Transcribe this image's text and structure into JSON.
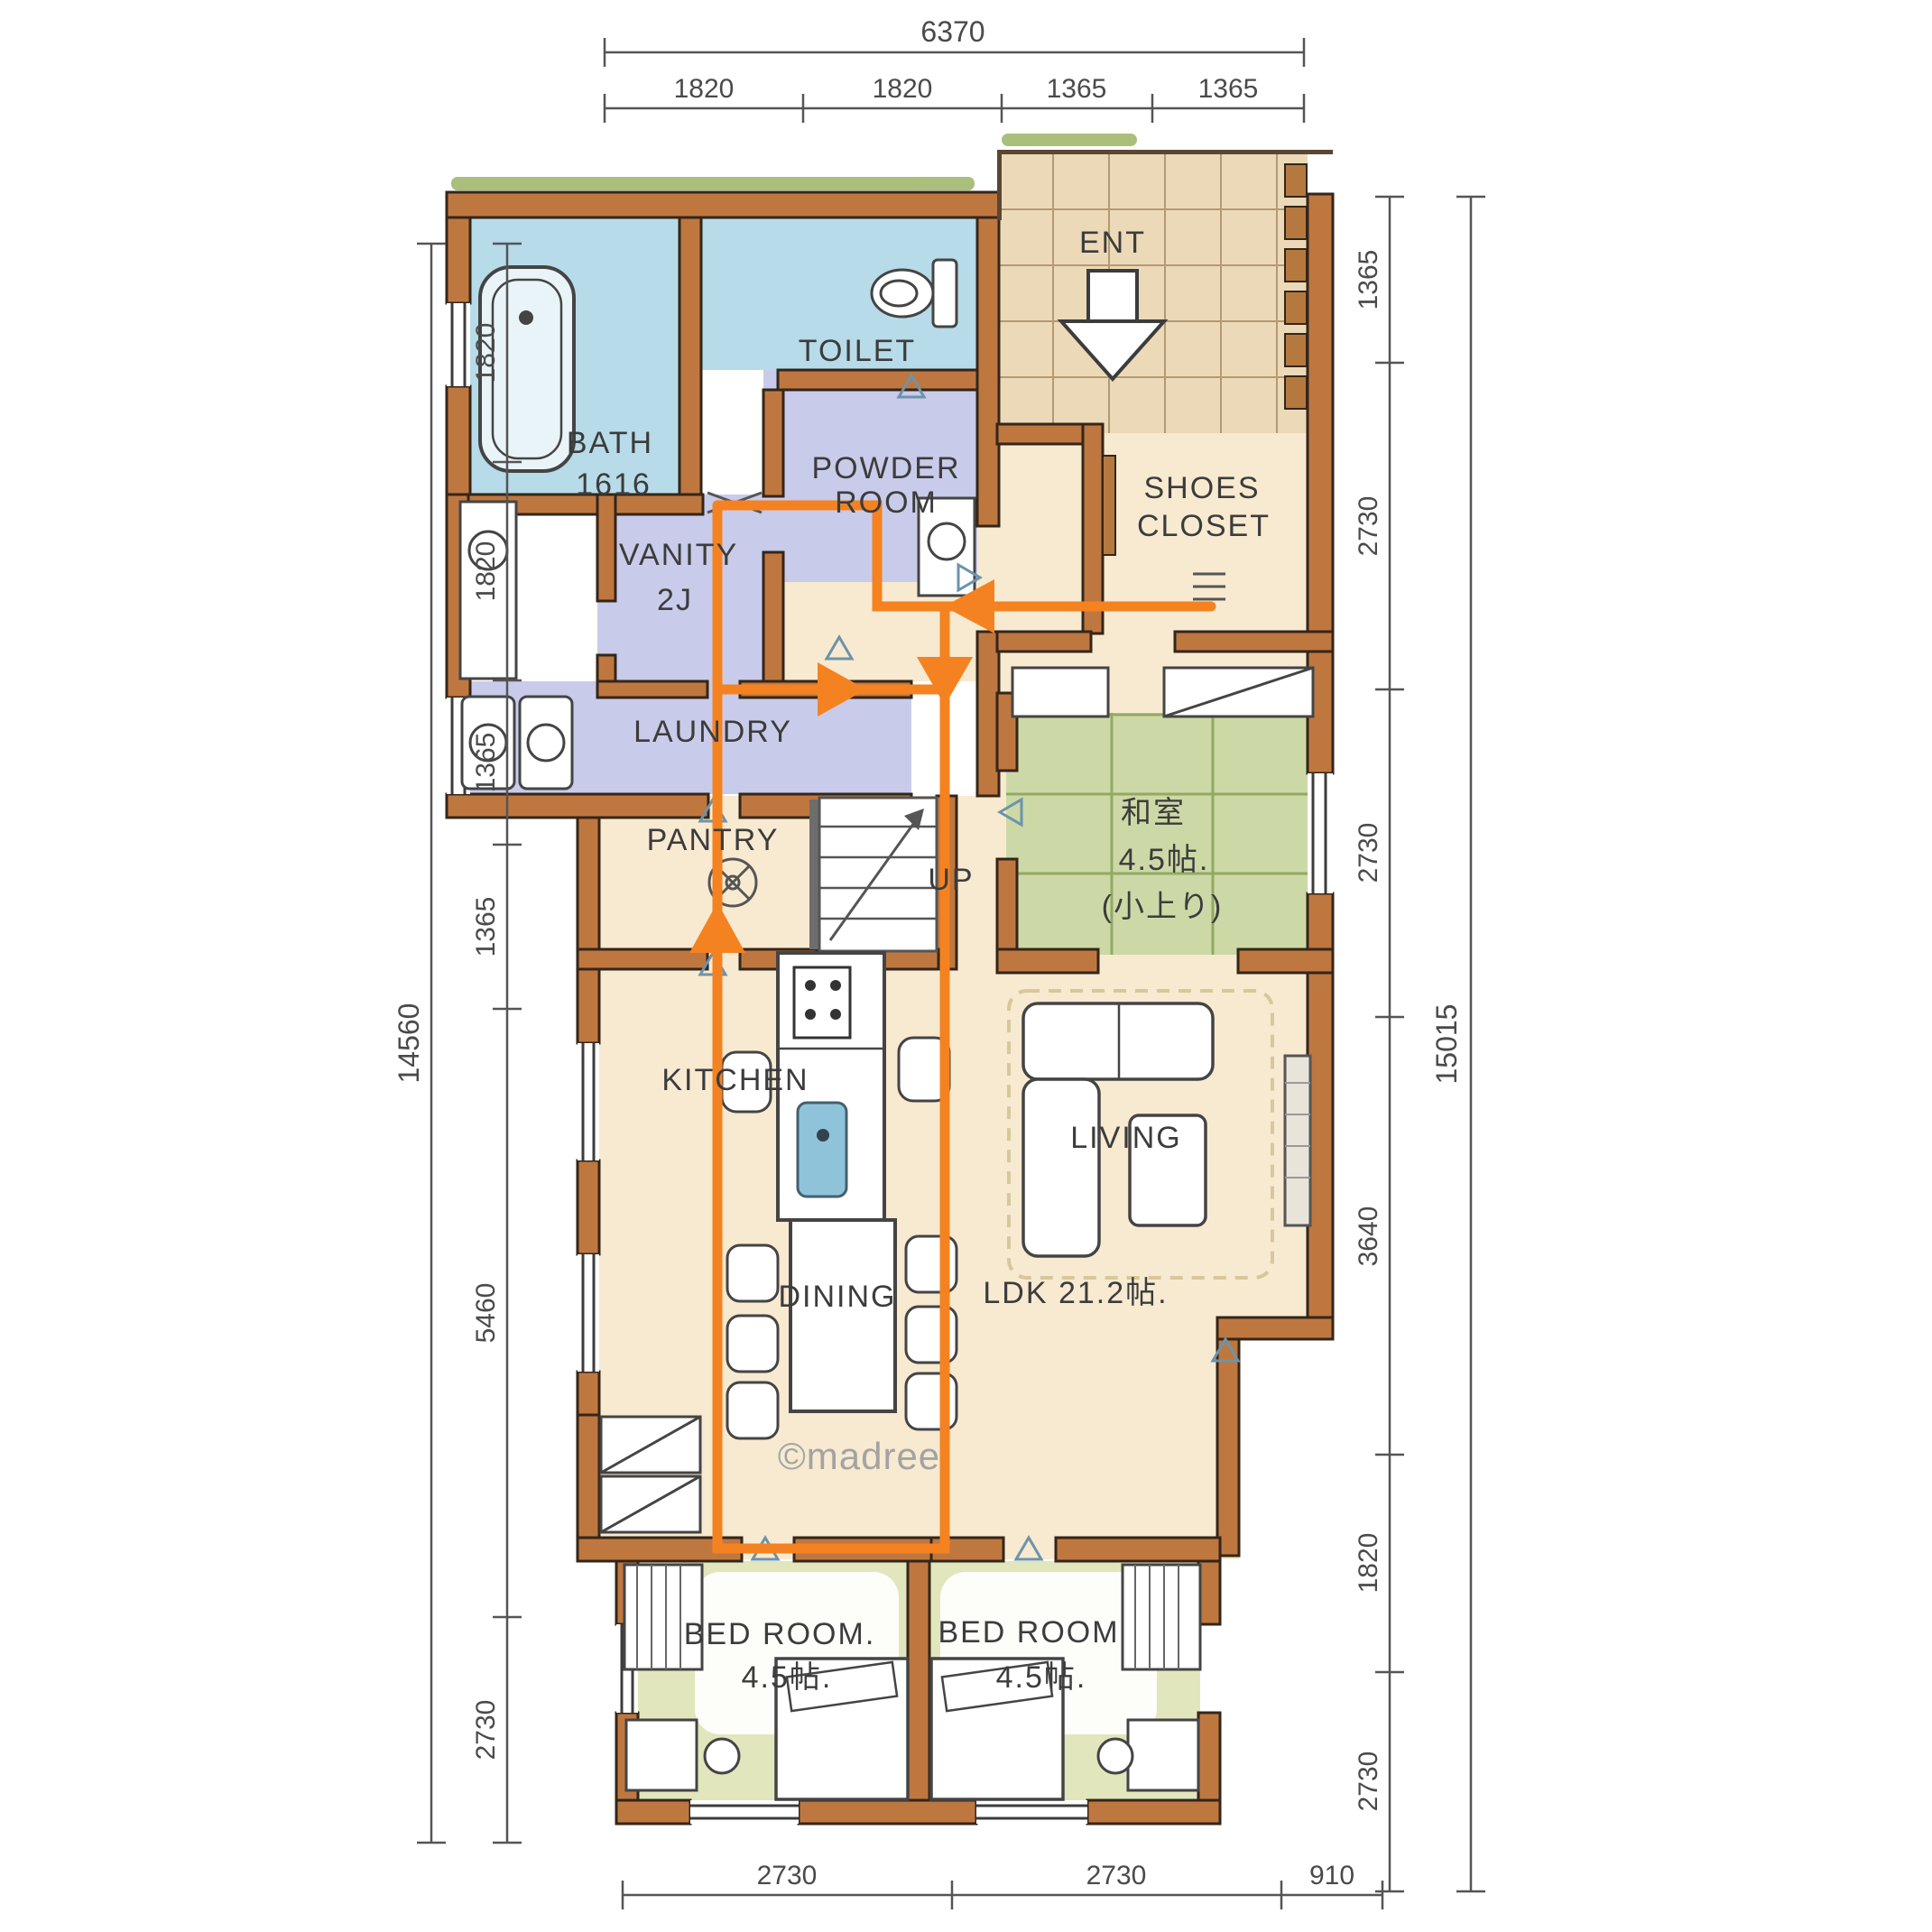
{
  "watermark": "©madree",
  "colors": {
    "wall": "#bf7740",
    "flow_line": "#f58220",
    "wet_area_floor": "#b7dbe8",
    "powder_floor": "#c9cbea",
    "entrance_tile_floor": "#ecd9b8",
    "wood_floor": "#f7ead0",
    "tatami_floor": "#ccd9a6",
    "bedroom_floor": "#e2e6bc",
    "dimension_ink": "#4a4a4a"
  },
  "rooms": {
    "ent": "ENT",
    "bath_line1": "BATH",
    "bath_line2": "1616",
    "toilet": "TOILET",
    "powder_line1": "POWDER",
    "powder_line2": "ROOM",
    "vanity_line1": "VANITY",
    "vanity_line2": "2J",
    "laundry": "LAUNDRY",
    "pantry": "PANTRY",
    "shoes_line1": "SHOES",
    "shoes_line2": "CLOSET",
    "stairs_up": "UP",
    "tatami_name": "和室",
    "tatami_size": "4.5帖.",
    "tatami_note": "(小上り)",
    "kitchen": "KITCHEN",
    "dining": "DINING",
    "living": "LIVING",
    "ldk": "LDK 21.2帖.",
    "bedroom1_line1": "BED ROOM.",
    "bedroom1_line2": "4.5帖.",
    "bedroom2_line1": "BED ROOM",
    "bedroom2_line2": "4.5帖."
  },
  "dimensions": {
    "top": {
      "total": "6370",
      "segments": [
        "1820",
        "1820",
        "1365",
        "1365"
      ]
    },
    "left": {
      "total": "14560",
      "segments": [
        "1820",
        "1820",
        "1365",
        "1365",
        "5460",
        "2730"
      ]
    },
    "right": {
      "total": "15015",
      "segments": [
        "1365",
        "2730",
        "2730",
        "3640",
        "1820",
        "2730"
      ]
    },
    "bottom": {
      "segments": [
        "2730",
        "2730",
        "910"
      ]
    }
  }
}
